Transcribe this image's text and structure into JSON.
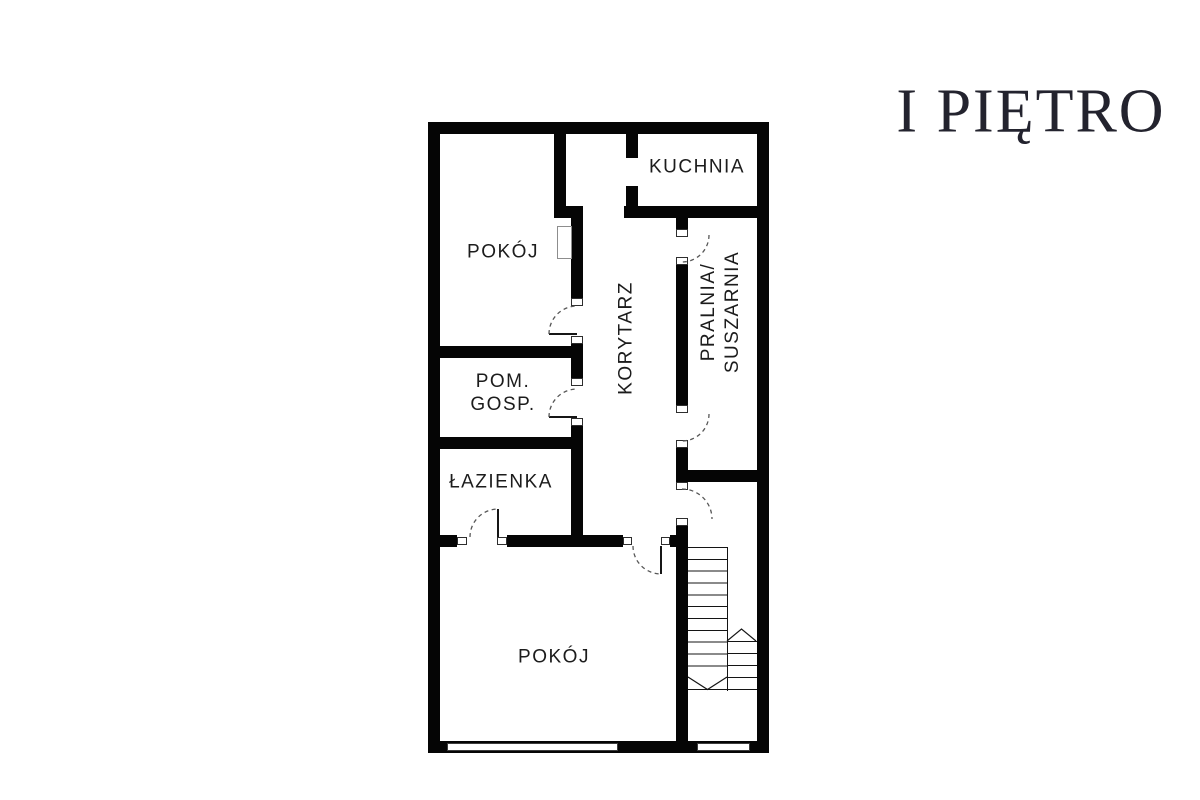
{
  "header": {
    "title": "I PIĘTRO"
  },
  "floor_plan": {
    "rooms": {
      "kuchnia": {
        "label": "KUCHNIA"
      },
      "pokoj_top": {
        "label": "POKÓJ"
      },
      "korytarz": {
        "label": "KORYTARZ"
      },
      "pralnia": {
        "line1": "PRALNIA/",
        "line2": "SUSZARNIA"
      },
      "pom_gosp": {
        "line1": "POM.",
        "line2": "GOSP."
      },
      "lazienka": {
        "label": "ŁAZIENKA"
      },
      "pokoj_bottom": {
        "label": "POKÓJ"
      }
    },
    "colors": {
      "wall": "#050505",
      "label_text": "#1c1c1c",
      "title_text": "#23232e"
    }
  }
}
